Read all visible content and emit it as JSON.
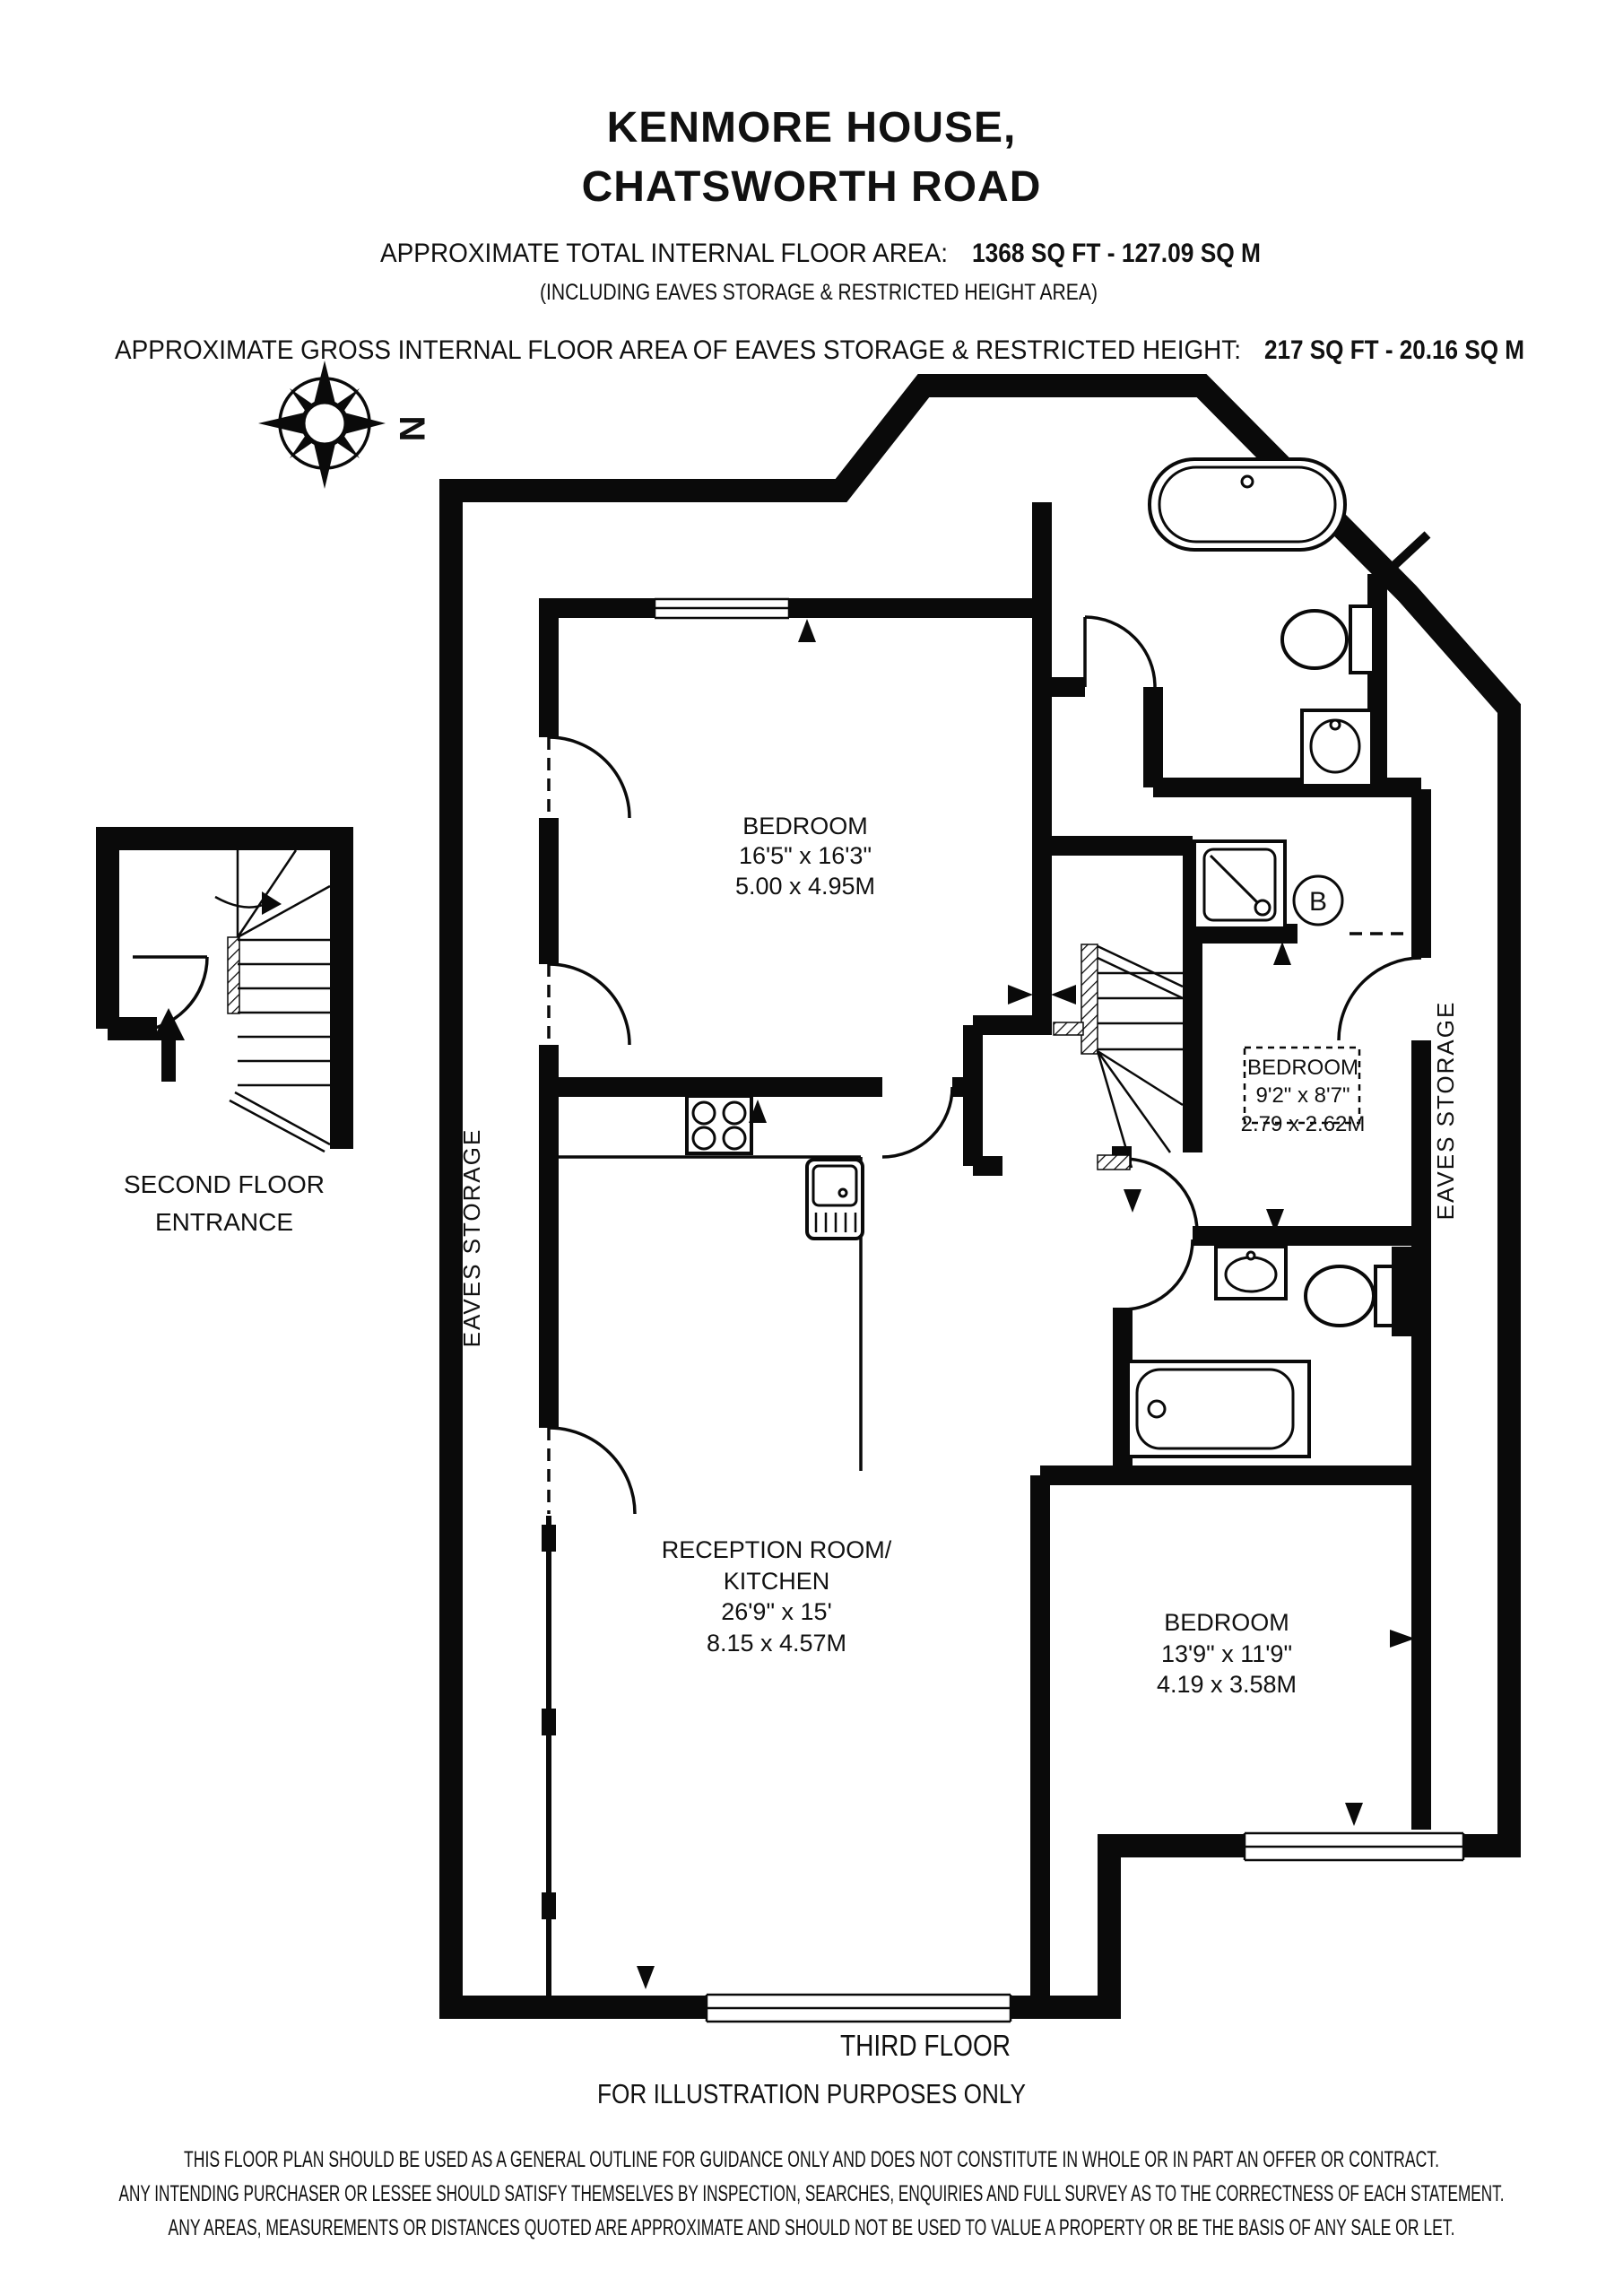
{
  "header": {
    "title_line1": "KENMORE HOUSE,",
    "title_line2": "CHATSWORTH ROAD",
    "total_area_label": "APPROXIMATE TOTAL INTERNAL FLOOR AREA:",
    "total_area_value": "1368 SQ FT - 127.09 SQ M",
    "including_note": "(INCLUDING EAVES STORAGE & RESTRICTED HEIGHT AREA)",
    "gross_area_label": "APPROXIMATE GROSS INTERNAL FLOOR AREA OF EAVES STORAGE & RESTRICTED HEIGHT:",
    "gross_area_value": "217 SQ FT - 20.16 SQ M"
  },
  "compass": {
    "north_label": "N"
  },
  "entrance_inset": {
    "label_line1": "SECOND FLOOR",
    "label_line2": "ENTRANCE"
  },
  "rooms": {
    "bedroom1": {
      "name": "BEDROOM",
      "imperial": "16'5\" x 16'3\"",
      "metric": "5.00 x 4.95M"
    },
    "bedroom2": {
      "name": "BEDROOM",
      "imperial": "9'2\" x 8'7\"",
      "metric": "2.79 x 2.62M"
    },
    "bedroom3": {
      "name": "BEDROOM",
      "imperial": "13'9\" x 11'9\"",
      "metric": "4.19 x 3.58M"
    },
    "reception": {
      "name_line1": "RECEPTION ROOM/",
      "name_line2": "KITCHEN",
      "imperial": "26'9\" x 15'",
      "metric": "8.15 x 4.57M"
    },
    "eaves_left": {
      "label": "EAVES STORAGE"
    },
    "eaves_right": {
      "label": "EAVES STORAGE"
    },
    "boiler_label": "B"
  },
  "footer": {
    "floor_label": "THIRD FLOOR",
    "illustration_note": "FOR ILLUSTRATION PURPOSES ONLY",
    "disclaimer_line1": "THIS FLOOR PLAN SHOULD BE USED AS A GENERAL OUTLINE FOR GUIDANCE ONLY AND DOES NOT CONSTITUTE IN WHOLE OR IN PART AN OFFER OR CONTRACT.",
    "disclaimer_line2": "ANY INTENDING PURCHASER OR LESSEE SHOULD SATISFY THEMSELVES BY INSPECTION, SEARCHES, ENQUIRIES AND FULL SURVEY AS TO THE CORRECTNESS OF EACH STATEMENT.",
    "disclaimer_line3": "ANY AREAS, MEASUREMENTS OR DISTANCES QUOTED ARE APPROXIMATE AND SHOULD NOT BE USED TO VALUE A PROPERTY OR BE THE BASIS OF ANY SALE OR LET."
  },
  "colors": {
    "wall": "#0a0a0a",
    "background": "#ffffff"
  }
}
